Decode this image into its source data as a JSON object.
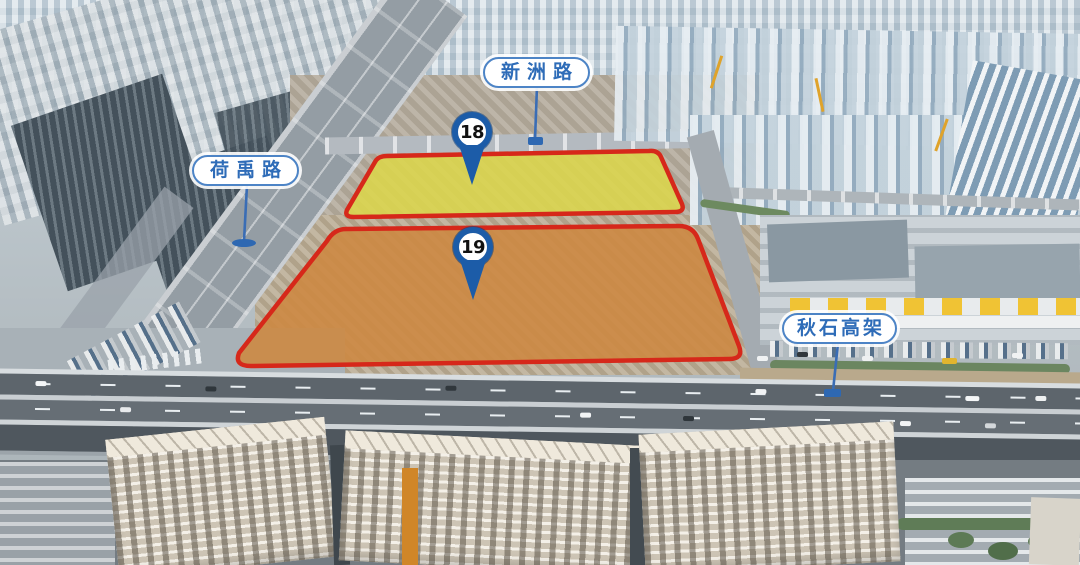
{
  "aerial_map": {
    "road_labels": [
      {
        "name": "xinzhou-road",
        "text": "新洲路"
      },
      {
        "name": "heyu-road",
        "text": "荷禹路"
      },
      {
        "name": "qiushi-elevated-road",
        "text": "秋石高架"
      }
    ],
    "parcels": [
      {
        "number": "18",
        "fill_color": "#dcd64b",
        "border_color": "#d6281a"
      },
      {
        "number": "19",
        "fill_color": "#cd8840",
        "border_color": "#d6281a"
      }
    ],
    "pin_color": "#1c5ca8",
    "label_text_color": "#2e6cb8",
    "connector_color": "#3a6db5"
  }
}
